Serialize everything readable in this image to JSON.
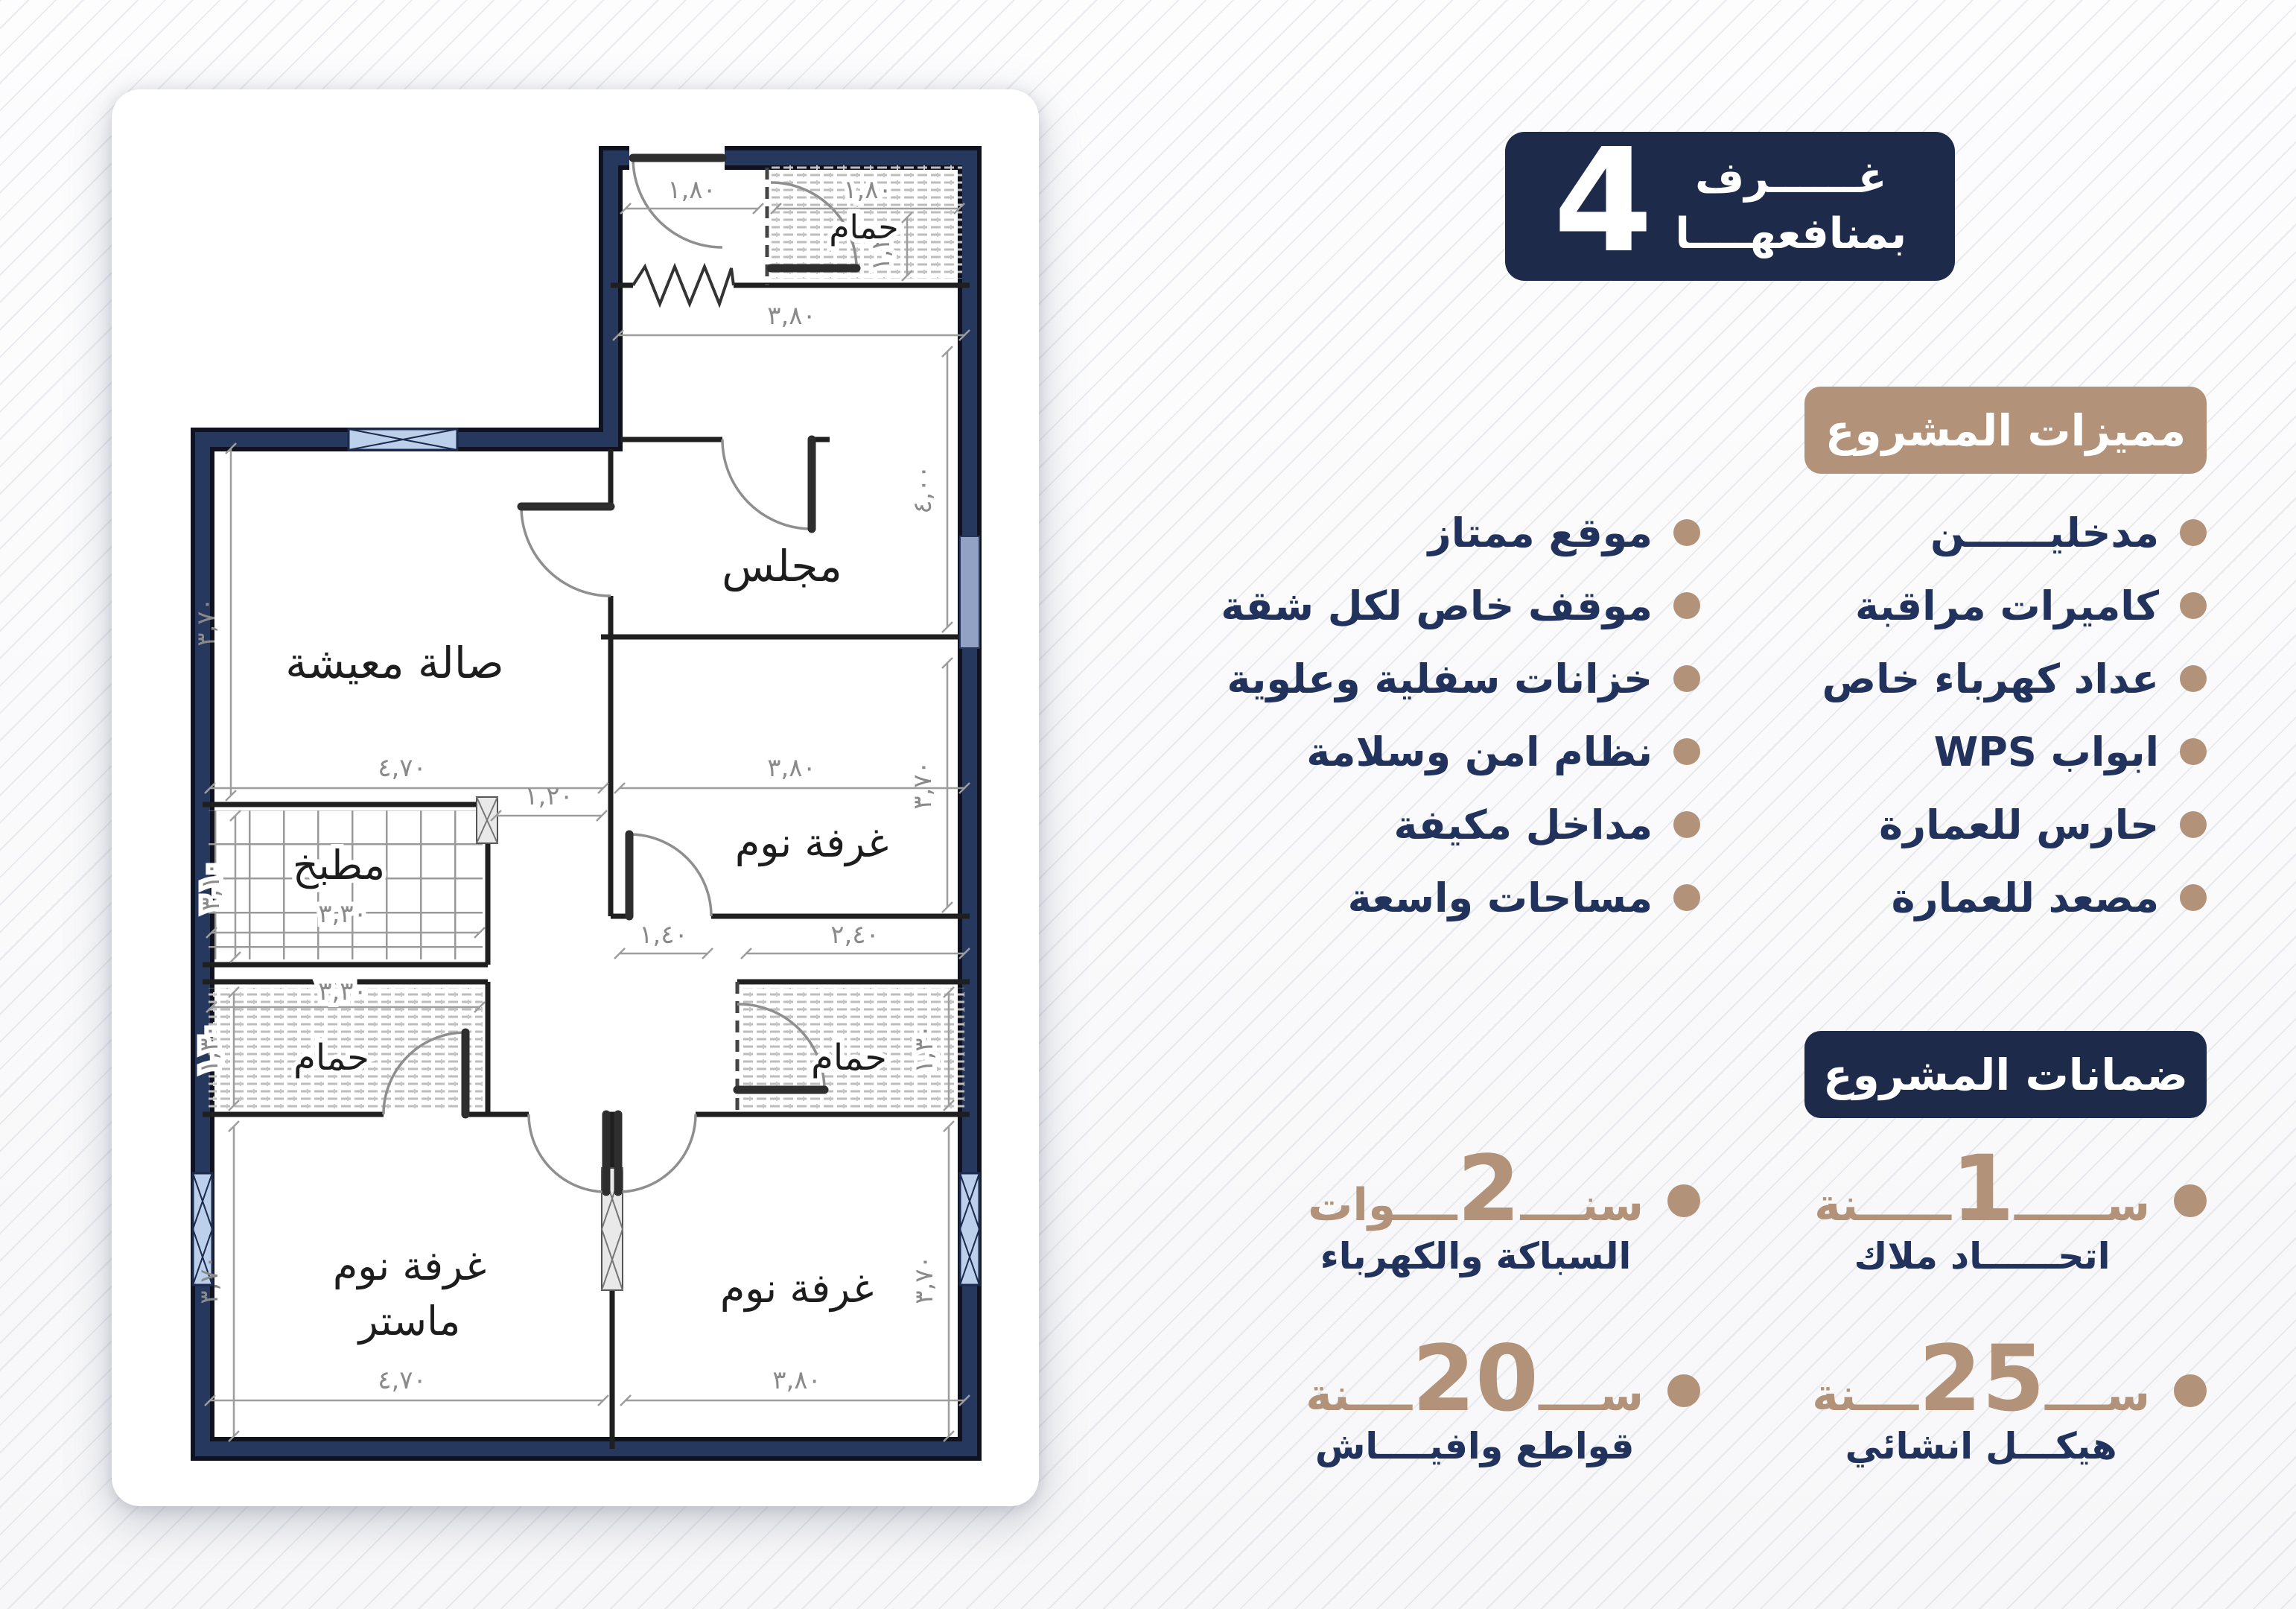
{
  "colors": {
    "navy": "#1e2a4a",
    "tan": "#b2937a",
    "text_navy": "#21325c"
  },
  "unit_badge": {
    "number": "4",
    "line1": "غــــــرف",
    "line2": "بمنافعهــــا"
  },
  "features": {
    "title": "مميزات المشروع",
    "rows": [
      {
        "r": "مدخليــــــن",
        "l": "موقع ممتاز"
      },
      {
        "r": "كاميرات مراقبة",
        "l": "موقف خاص لكل شقة"
      },
      {
        "r": "عداد كهرباء خاص",
        "l": "خزانات سفلية وعلوية"
      },
      {
        "r": "ابواب WPS",
        "l": "نظام امن وسلامة"
      },
      {
        "r": "حارس للعمارة",
        "l": "مداخل مكيفة"
      },
      {
        "r": "مصعد للعمارة",
        "l": "مساحات واسعة"
      }
    ]
  },
  "guarantees": {
    "title": "ضمانات المشروع",
    "items": [
      {
        "pre": "ســــــ",
        "num": "1",
        "post": "ــــــنة",
        "label": "اتحــــــاد ملاك"
      },
      {
        "pre": "سنــــ",
        "num": "2",
        "post": "ــــوات",
        "label": "السباكة والكهرباء"
      },
      {
        "pre": "ســــ",
        "num": "25",
        "post": "ــــنة",
        "label": "هيكـــل انشائي"
      },
      {
        "pre": "ســــ",
        "num": "20",
        "post": "ــــنة",
        "label": "قواطع وافيــــاش"
      }
    ]
  },
  "plan": {
    "rooms": [
      "حمام",
      "مجلس",
      "صالة معيشة",
      "مطبخ",
      "حمام",
      "حمام",
      "غرفة نوم",
      "غرفة نوم",
      "ماستر",
      "غرفة نوم"
    ],
    "dims": {
      "entrance_w": "١,٨٠",
      "bath_top_w": "١,٨٠",
      "bath_top_h": "١,٢٠",
      "majlis_w": "٣,٨٠",
      "majlis_h": "٤,٠٠",
      "living_h": "٣,٧٠",
      "living_w": "٤,٧٠",
      "bed_mid_w": "٣,٨٠",
      "bed_mid_h": "٣,٧٠",
      "kitchen_h": "٣,١٠",
      "kitchen_w": "٣,٣٠",
      "corr_top": "١,٢٠",
      "corr_bottom": "١,٤٠",
      "bath_l_w": "٣,٣٠",
      "bath_l_h": "١,٣٠",
      "bath_r_w": "٢,٤٠",
      "bath_r_h": "١,٣٠",
      "master_h": "٣,٧٠",
      "master_w": "٤,٧٠",
      "bed_br_w": "٣,٨٠",
      "bed_br_h": "٣,٧٠"
    }
  }
}
